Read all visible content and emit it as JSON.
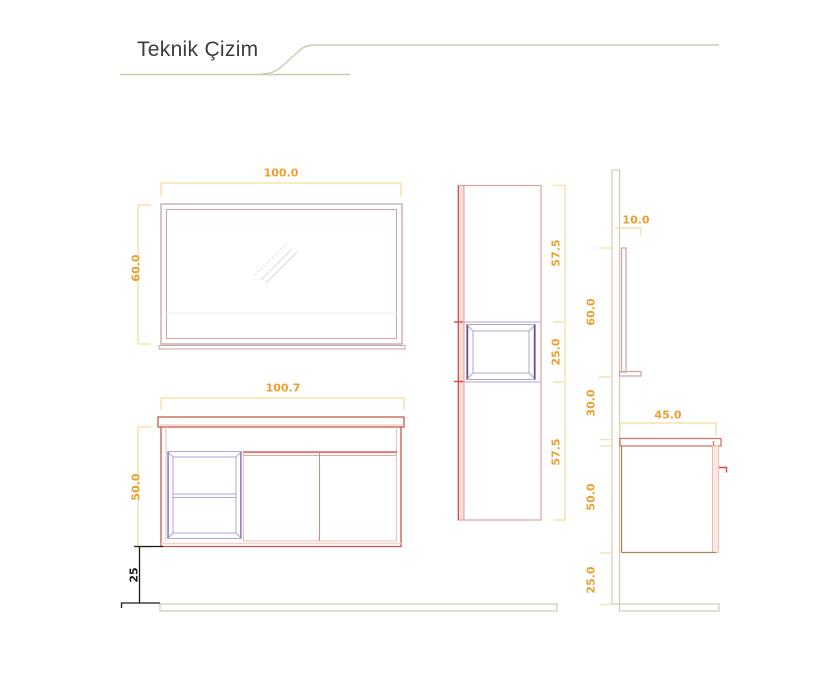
{
  "header": {
    "title": "Teknik Çizim"
  },
  "colors": {
    "dimension_text": "#ED9F2D",
    "dimension_line": "#F6E2AE",
    "black_dimension": "#1A1A1A",
    "cabinet_outline": "#C4584E",
    "cabinet_pink": "#F0BDB3",
    "mirror_frame": "#C9A4A4",
    "shelf_lavender": "#AFA5D3",
    "niche_purple": "#6F5596",
    "accent_red": "#E0473F",
    "divider_salmon": "#D9897E",
    "wall_floor_line": "#CACAB0",
    "side_body_brown": "#A8854E"
  },
  "dimensions": {
    "mirror_front": {
      "width": "100.0",
      "height": "60.0"
    },
    "vanity_front": {
      "width": "100.7",
      "height": "50.0",
      "plinth": "25"
    },
    "tall_cabinet": {
      "top": "57.5",
      "middle": "25.0",
      "bottom": "57.5"
    },
    "side_view": {
      "shelf_depth": "10.0",
      "mirror_height": "60.0",
      "wall_gap": "30.0",
      "counter_depth": "45.0",
      "cabinet_height": "50.0",
      "plinth": "25.0"
    }
  }
}
